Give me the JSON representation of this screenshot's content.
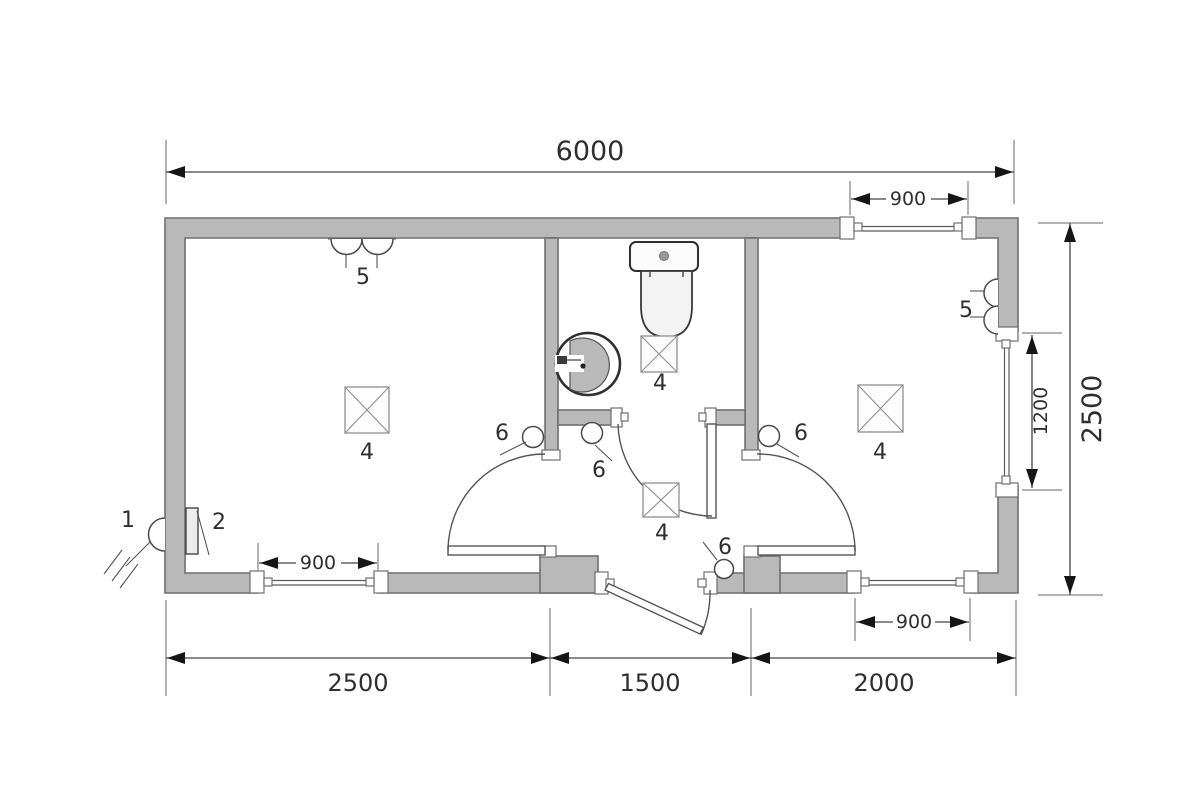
{
  "figure": {
    "title": "room floor plan",
    "background_color": "#ffffff",
    "wall_fill_color": "#b9b9b9",
    "wall_outline_color": "#6f6f6f",
    "dimension_line_color": "#444444",
    "text_color": "#2f2f2f"
  },
  "dimensions": {
    "overall_width": "6000",
    "overall_depth": "2500",
    "left_room_width": "2500",
    "middle_section_width": "1500",
    "right_room_width": "2000",
    "left_window_width": "900",
    "top_right_window_width": "900",
    "bottom_right_window_width": "900",
    "side_window_height": "1200"
  },
  "callouts": {
    "outdoor_light": "1",
    "switchboard": "2",
    "floor_drain": "4",
    "wall_lamp": "5",
    "door_device": "6"
  }
}
